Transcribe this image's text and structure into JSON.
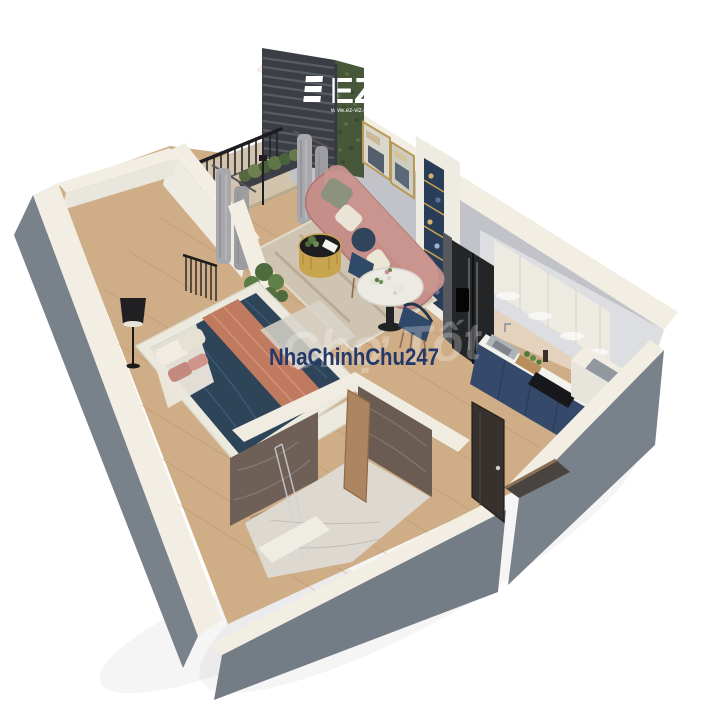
{
  "branding": {
    "logo_text": "EZ",
    "logo_tagline": "www.ez-viz.com",
    "logo_color": "#ffffff"
  },
  "watermarks": {
    "primary_text": "NhaChinhChu247",
    "primary_color": "#24396a",
    "ghost_text": "Chợ Tốt",
    "ghost_color": "#ffffff"
  },
  "palette": {
    "background": "#ffffff",
    "exterior_wall": "#79818b",
    "wall_top": "#f2eee3",
    "interior_wall": "#c2c3c9",
    "white_partition": "#eeebe3",
    "wood_floor": "#cfae87",
    "balcony_floor": "#d2c3ac",
    "rug": "#cfc4b2",
    "sofa_coral": "#c68e88",
    "bed_duvet_navy": "#2e4459",
    "bed_throw_rust": "#c07a5f",
    "bed_frame_white": "#eceade",
    "curtain_gray": "#a8a8ac",
    "louver_dark": "#3b3e44",
    "green_wall": "#47583a",
    "plant_green": "#5a7a46",
    "kitchen_upper_white": "#edeae2",
    "kitchen_base_navy": "#35496b",
    "countertop_white": "#f4f2ec",
    "refrigerator_black": "#232527",
    "gold_accent": "#c9a44e",
    "marble_wall_brown": "#6e6057",
    "marble_floor_white": "#ddd8d0",
    "dining_chair_navy": "#2e4a66",
    "dining_table_white": "#eceae2",
    "entry_door_dark": "#37312d",
    "bathroom_door_wood": "#ad8560",
    "railing_black": "#1d1d20"
  }
}
